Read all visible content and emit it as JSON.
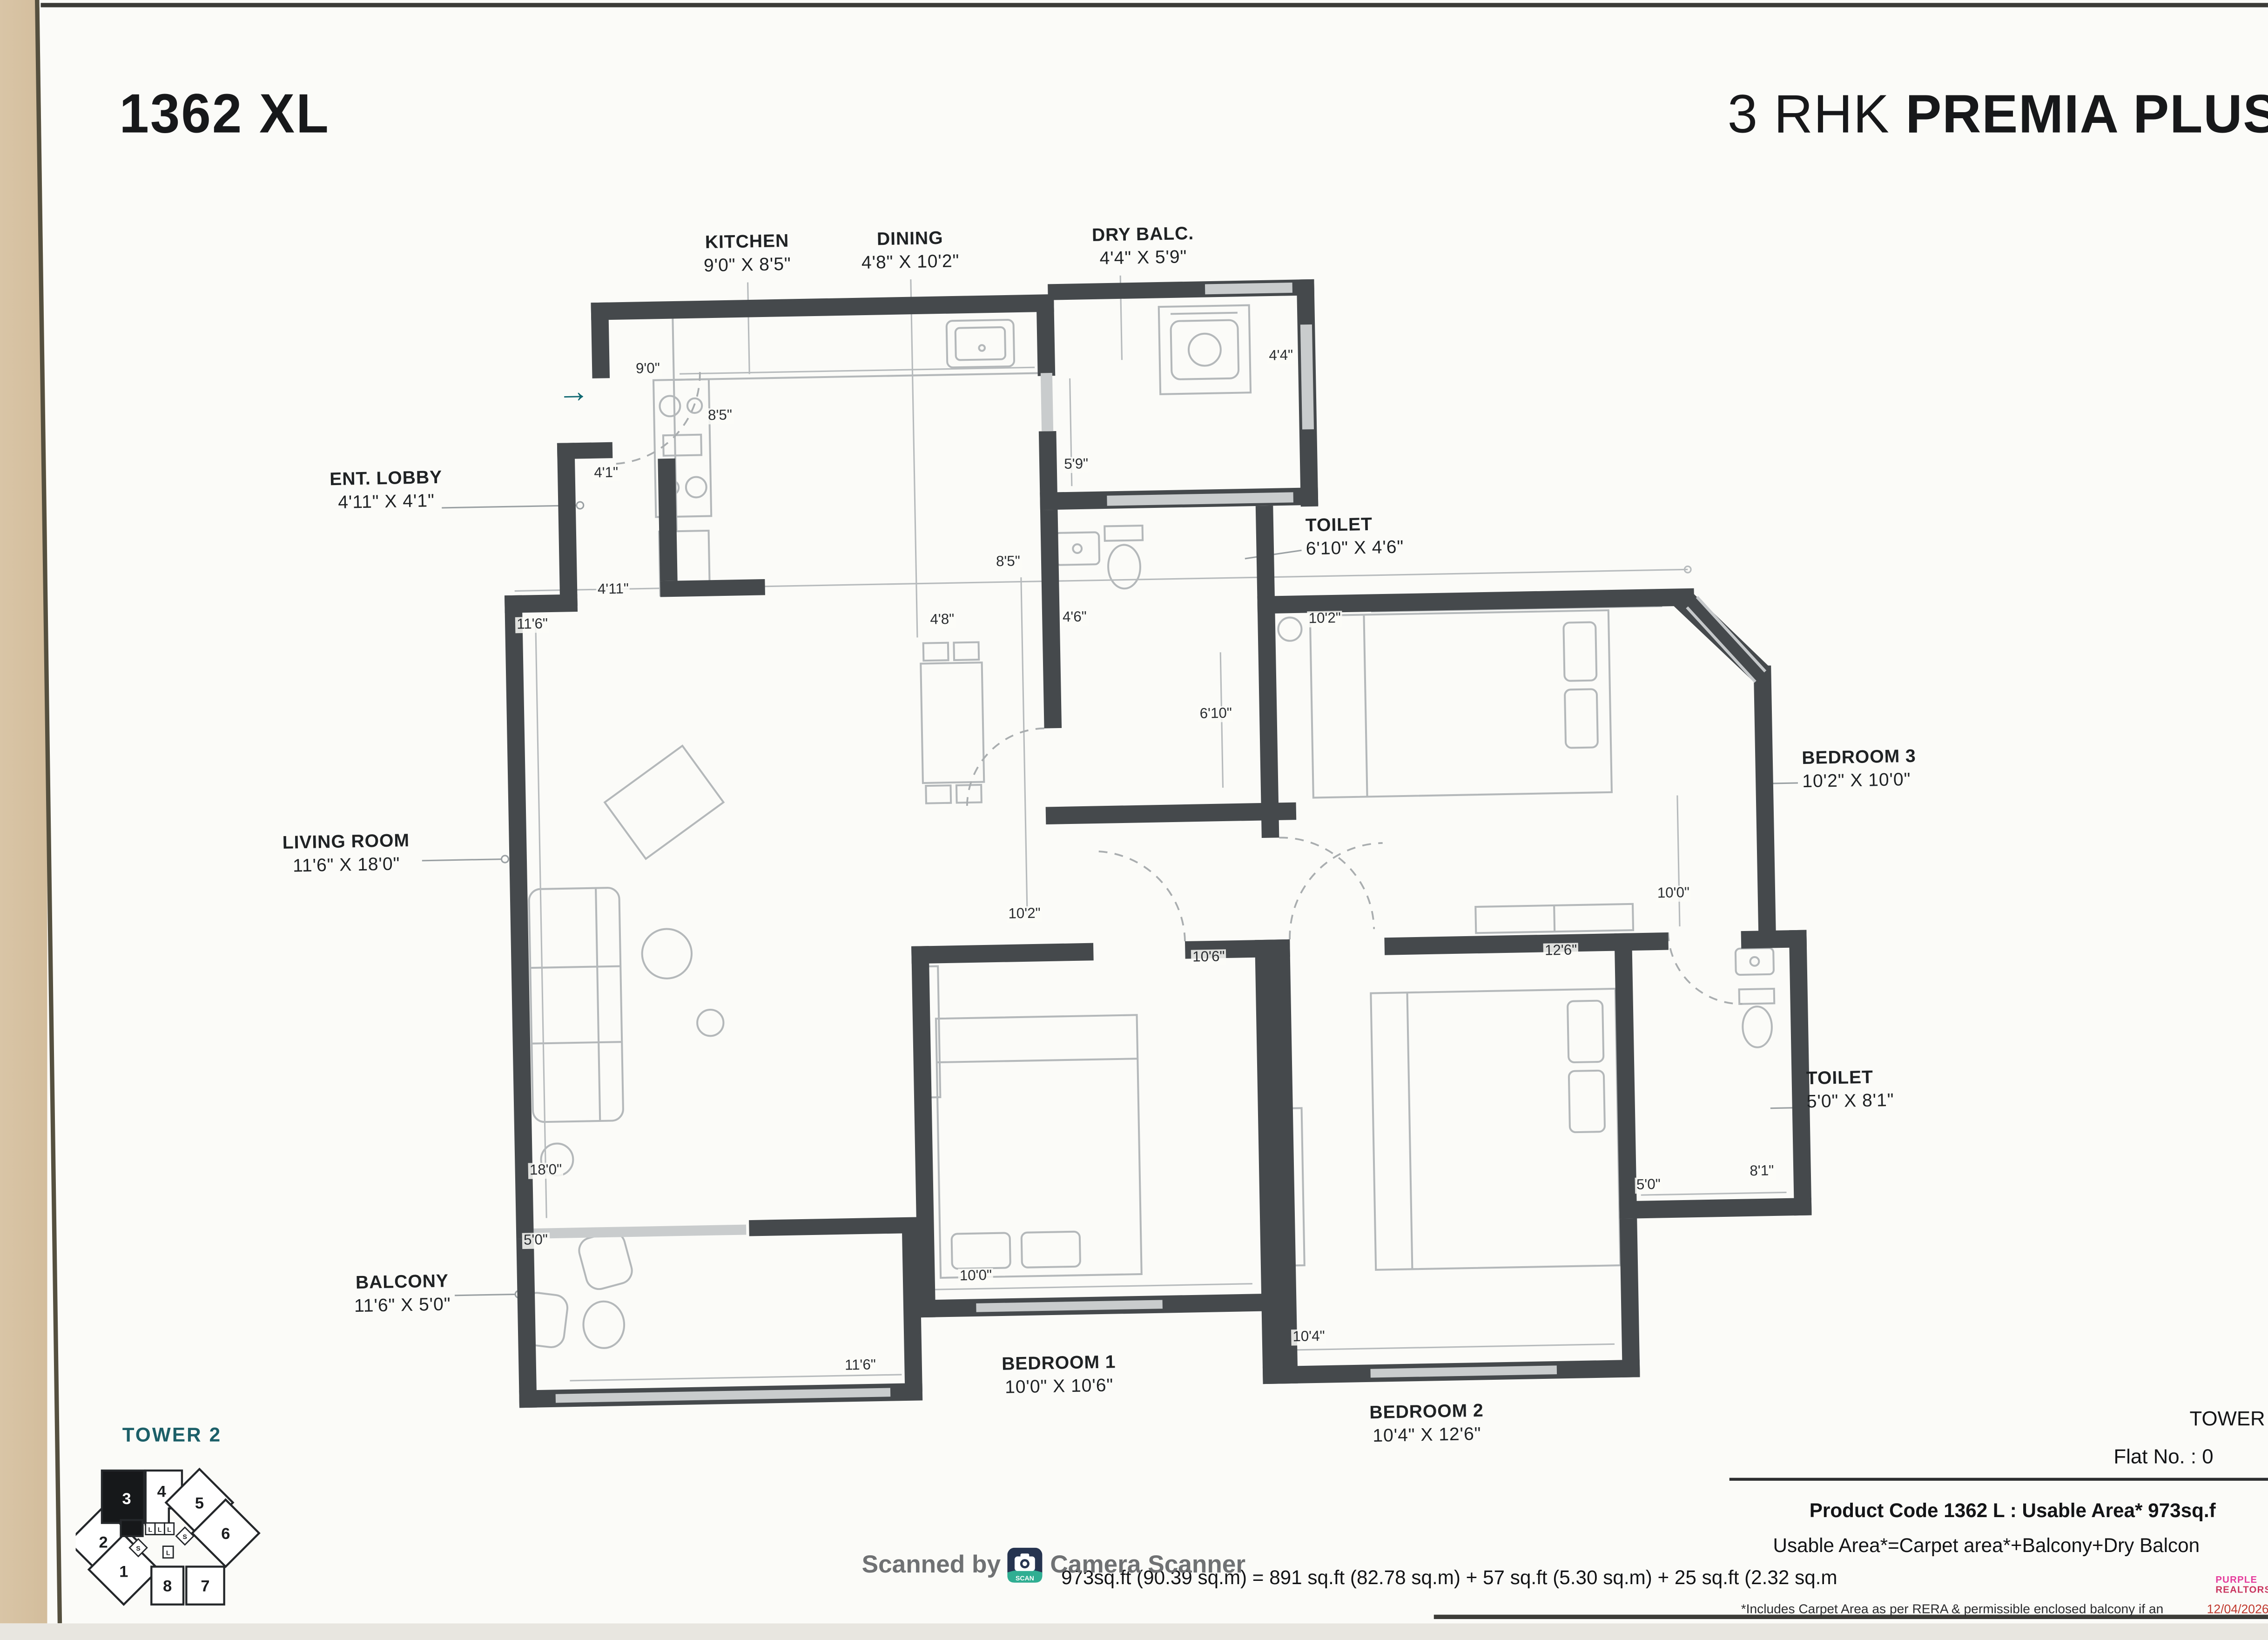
{
  "header": {
    "title_left": "1362 XL",
    "title_right_light": "3 RHK ",
    "title_right_bold": "PREMIA PLUS"
  },
  "entry_arrow": "→",
  "rooms": [
    {
      "name": "KITCHEN",
      "dims": "9'0\" X 8'5\""
    },
    {
      "name": "DINING",
      "dims": "4'8\" X 10'2\""
    },
    {
      "name": "DRY BALC.",
      "dims": "4'4\" X 5'9\""
    },
    {
      "name": "ENT. LOBBY",
      "dims": "4'11\" X 4'1\""
    },
    {
      "name": "TOILET",
      "dims": "6'10\" X 4'6\""
    },
    {
      "name": "LIVING ROOM",
      "dims": "11'6\" X 18'0\""
    },
    {
      "name": "BEDROOM 3",
      "dims": "10'2\" X 10'0\""
    },
    {
      "name": "TOILET",
      "dims": "5'0\" X 8'1\""
    },
    {
      "name": "BALCONY",
      "dims": "11'6\" X 5'0\""
    },
    {
      "name": "BEDROOM 1",
      "dims": "10'0\" X 10'6\""
    },
    {
      "name": "BEDROOM 2",
      "dims": "10'4\" X 12'6\""
    }
  ],
  "dim_labels": [
    "8'5\"",
    "9'0\"",
    "4'4\"",
    "4'1\"",
    "5'9\"",
    "4'11\"",
    "11'6\"",
    "8'5\"",
    "4'8\"",
    "4'6\"",
    "6'10\"",
    "10'2\"",
    "10'0\"",
    "10'2\"",
    "10'6\"",
    "12'6\"",
    "18'0\"",
    "5'0\"",
    "10'0\"",
    "5'0\"",
    "8'1\"",
    "11'6\"",
    "10'4\""
  ],
  "keyplan": {
    "title": "TOWER 2",
    "units": [
      "1",
      "2",
      "3",
      "4",
      "5",
      "6",
      "7",
      "8"
    ],
    "lift": "L",
    "stair": "S",
    "highlighted_unit": "3"
  },
  "watermark": {
    "prefix": "Scanned by",
    "suffix": "Camera Scanner",
    "badge": "SCAN"
  },
  "footer": {
    "tower": "TOWER",
    "flat_no": "Flat No. : 0",
    "line1": "Product Code 1362 L : Usable Area* 973sq.f",
    "line2": "Usable Area*=Carpet area*+Balcony+Dry Balcon",
    "line3": "973sq.ft (90.39 sq.m) = 891 sq.ft (82.78 sq.m) + 57 sq.ft (5.30 sq.m) + 25 sq.ft (2.32 sq.m",
    "line4": "*Includes Carpet Area as per RERA & permissible enclosed balcony if an",
    "logo_line1": "PURPLE",
    "logo_line2": "REALTORS",
    "date": "12/04/2026"
  },
  "colors": {
    "wall": "#45494c",
    "accent_teal": "#0f6871",
    "keyplan_teal": "#1c5f68",
    "watermark_gray": "#6f7173",
    "scan_badge_navy": "#263450",
    "scan_badge_teal": "#2fae92",
    "paper_edge_beige": "#d9c5a6",
    "furniture_gray": "#b4b8ba"
  }
}
